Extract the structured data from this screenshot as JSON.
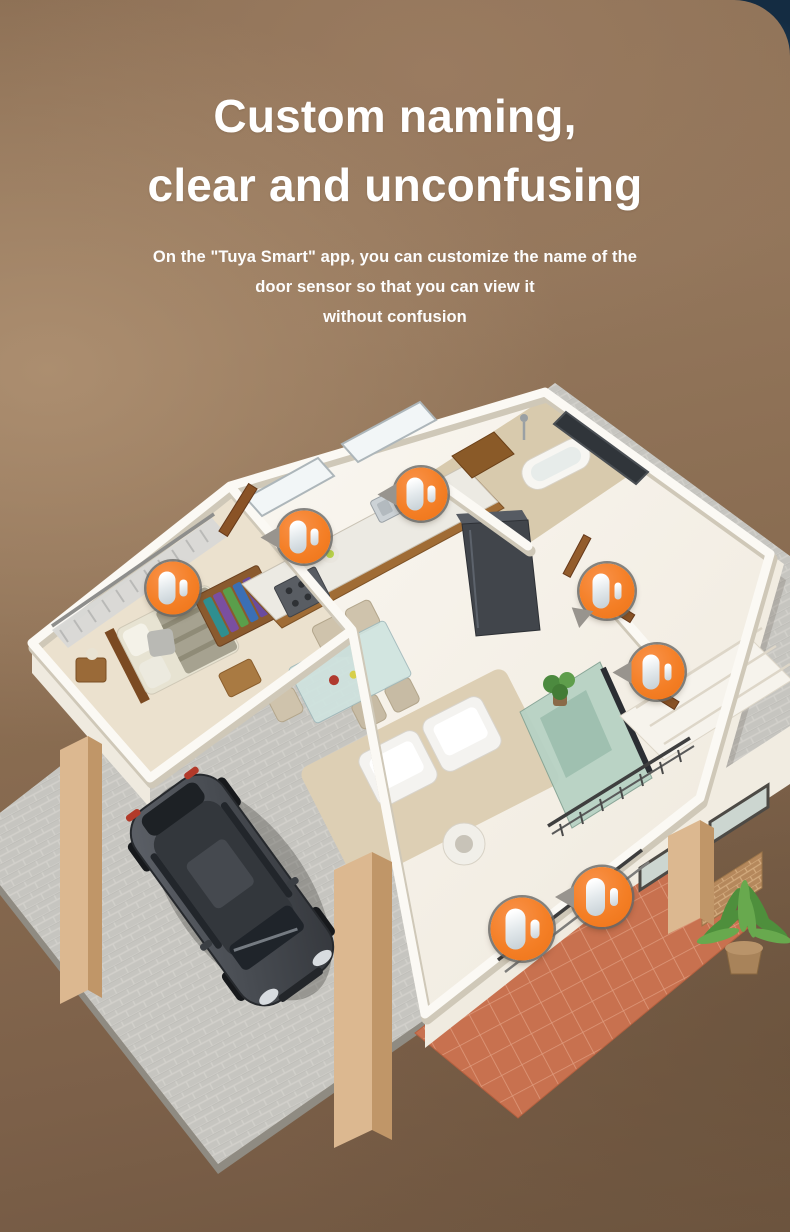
{
  "theme": {
    "accent_orange": "#f47f26",
    "background_brown": "#8b6e53",
    "background_brown_dark": "#6f5640",
    "corner_navy": "#1b3650",
    "corner_sky": "#9cc0d8",
    "headline_color": "#ffffff",
    "platform_gray": "#c3c2bd",
    "patio_terracotta": "#c8714f",
    "plant_green": "#4e8f3c"
  },
  "headline": {
    "line1": "Custom naming,",
    "line2": "clear and unconfusing"
  },
  "subheadline": {
    "line1": "On the \"Tuya Smart\" app, you can customize the name of the",
    "line2": "door sensor so that you can view it",
    "line3": "without confusion"
  },
  "illustration": {
    "label": "isometric-smart-home-floor-plan",
    "sensor_icon": "door-sensor-icon"
  },
  "sensors": {
    "count": 7,
    "markers": [
      {
        "id": 1,
        "x": 173,
        "y": 210,
        "size": 53,
        "tail": "none"
      },
      {
        "id": 2,
        "x": 304,
        "y": 159,
        "size": 53,
        "tail": "left"
      },
      {
        "id": 3,
        "x": 421,
        "y": 116,
        "size": 53,
        "tail": "left"
      },
      {
        "id": 4,
        "x": 607,
        "y": 213,
        "size": 55,
        "tail": "downleft"
      },
      {
        "id": 5,
        "x": 657,
        "y": 294,
        "size": 55,
        "tail": "left"
      },
      {
        "id": 6,
        "x": 522,
        "y": 551,
        "size": 63,
        "tail": "none"
      },
      {
        "id": 7,
        "x": 602,
        "y": 519,
        "size": 60,
        "tail": "left"
      }
    ]
  }
}
